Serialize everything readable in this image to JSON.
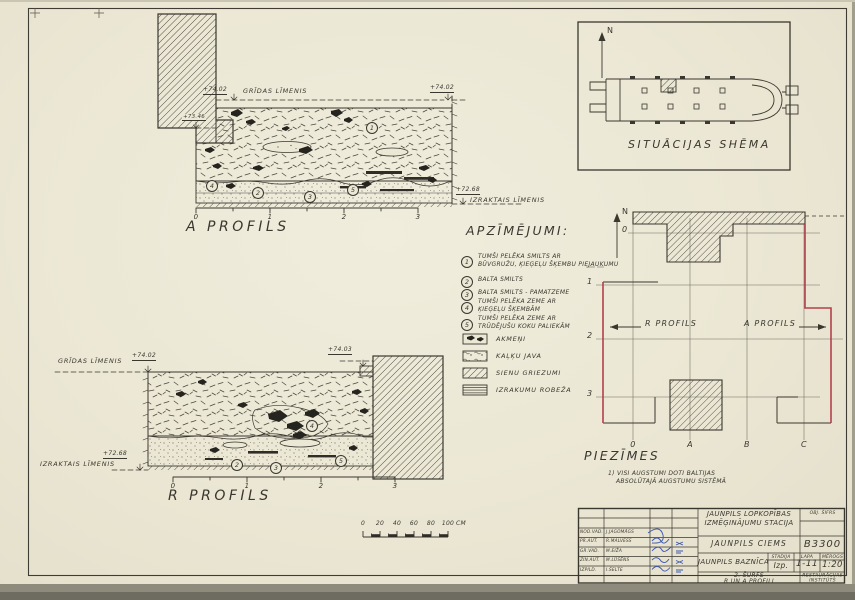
{
  "sheet": {
    "paper_color": "#ece8d6",
    "ink_color": "#3a372f",
    "red_color": "#b2414b",
    "blue_color": "#3d57ae"
  },
  "profile_a": {
    "title": "A PROFILS",
    "floor_label": "GRĪDAS LĪMENIS",
    "floor_elev": "+74.02",
    "ledge_elev": "+73.46",
    "right_elev": "+74.02",
    "excavated_elev": "+72.68",
    "excavated_label": "IZRAKTAIS LĪMENIS",
    "ruler": [
      "0",
      "1",
      "2",
      "3"
    ]
  },
  "profile_r": {
    "title": "R PROFILS",
    "floor_label": "GRĪDAS LĪMENIS",
    "floor_elev": "+74.02",
    "right_elev": "+74.03",
    "excavated_elev": "+72.68",
    "excavated_label": "IZRAKTAIS LĪMENIS",
    "ruler": [
      "0",
      "1",
      "2",
      "3"
    ]
  },
  "layers": {
    "1": "1",
    "2": "2",
    "3": "3",
    "4": "4",
    "5": "5"
  },
  "legend": {
    "title": "APZĪMĒJUMI:",
    "items": [
      {
        "num": "1",
        "line1": "TUMŠI PELĒKA SMILTS AR",
        "line2": "BŪVGRUŽU, ĶIEĢEĻU ŠĶEMBU PIEJAUKUMU"
      },
      {
        "num": "2",
        "line1": "BALTA SMILTS",
        "line2": ""
      },
      {
        "num": "3",
        "line1": "BALTA SMILTS - PAMATZEME",
        "line2": ""
      },
      {
        "num": "4",
        "line1": "TUMŠI PELĒKA ZEME AR",
        "line2": "ĶIEĢEĻU ŠĶEMBĀM"
      },
      {
        "num": "5",
        "line1": "TUMŠI PELĒKA ZEME AR",
        "line2": "TRŪDĒJUŠU KOKU PALIEKĀM"
      }
    ],
    "symbols": [
      {
        "label": "AKMEŅI"
      },
      {
        "label": "KAĻĶU JAVA"
      },
      {
        "label": "SIENU GRIEZUMI"
      },
      {
        "label": "IZRAKUMU ROBEŽA"
      }
    ]
  },
  "situation": {
    "title": "SITUĀCIJAS SHĒMA",
    "north": "N"
  },
  "plan": {
    "north": "N",
    "rows": [
      "0",
      "1",
      "2",
      "3"
    ],
    "cols": [
      "0",
      "A",
      "B",
      "C"
    ],
    "left_profile": "R PROFILS",
    "right_profile": "A PROFILS"
  },
  "notes": {
    "title": "PIEZĪMES",
    "line1": "1) VISI AUGSTUMI DOTI BALTIJAS",
    "line2": "ABSOLŪTAJĀ AUGSTUMU SISTĒMĀ"
  },
  "scalebar": {
    "ticks": [
      "0",
      "20",
      "40",
      "60",
      "80",
      "100"
    ],
    "unit": "CM"
  },
  "titleblock": {
    "project_line1": "JAUNPILS LOPKOPĪBAS",
    "project_line2": "IZMĒĢINĀJUMU STACIJA",
    "object_code_label": "OBJ. ŠIFRS",
    "village": "JAUNPILS CIEMS",
    "code": "B3300",
    "building": "JAUNPILS BAZNĪCA",
    "col_stage": "STADIJA",
    "col_sheet": "LAPA",
    "col_scale": "MĒROGS",
    "stage": "Izp.",
    "sheet": "1-11",
    "scale": "1:20",
    "drawing_line1": "2. ŠURFS",
    "drawing_line2": "R UN A PROFILI",
    "org_line1": "RESTAURĀCIJAS",
    "org_line2": "INSTITŪTS",
    "staff": [
      {
        "role": "NOD.VAD.",
        "name": "J.JAGOMĀGS"
      },
      {
        "role": "PR.AUT.",
        "name": "R.MALVESS"
      },
      {
        "role": "GR.VAD.",
        "name": "M.EIŽA"
      },
      {
        "role": "ZIN.AUT.",
        "name": "M.LŪSĒNS"
      },
      {
        "role": "IZPILD.",
        "name": "I.ŠELTE"
      }
    ]
  }
}
